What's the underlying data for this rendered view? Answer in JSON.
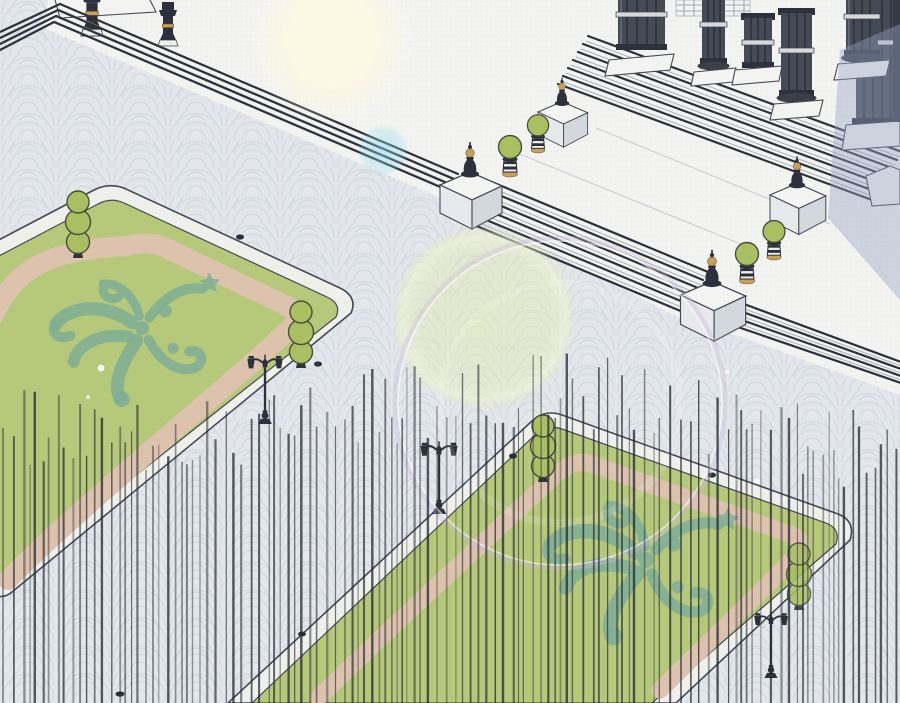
{
  "scene": {
    "title": "Palace courtyard plaza — isometric illustration",
    "description": "Overhead isometric webtoon-style background: a white stone colonnade terrace with two flights of grand stairs descends to a grey fan-patterned plaza. Two large lawn parterres with rounded white curbs contain pink walking paths and teal ornamental scroll emblems, flanked by stacked-ball topiaries and slim double-headed lamp posts. Urn finials on white pedestals and potted topiaries line the stairs. Soft lens flares float over the scene and a curtain of fine vertical screentone lines covers the lower half.",
    "style": "manhwa / webtoon background art",
    "time_of_day": "daylight"
  },
  "palette": {
    "plaza": "#e3e6ea",
    "pattern": "#c3cad4",
    "terrace": "#f3f4f2",
    "ink": "#2c313b",
    "outline": "#454a53",
    "curb": "#eff0ec",
    "lawn": "#b6c87a",
    "pink": "#ddc3ae",
    "orn": "#7fae96",
    "topiary": "#a9bf62",
    "gold": "#c9a05a",
    "shadow": "#96a3c4",
    "glow": "#fdf7e2",
    "flare_yellow": "#e3edaa",
    "flare_cyan": "#8cd7eb",
    "vline": "#272c36"
  },
  "objects": {
    "building": {
      "label": "colonnade portico",
      "columns": 6,
      "features": [
        "fluted dark columns",
        "light ring bands",
        "white plinths",
        "coffered wall panel",
        "cast shadow to lower right"
      ]
    },
    "stairs": {
      "label": "grand staircase",
      "flights": 2,
      "low_curb_bands": 2,
      "direction": "descends toward lower left"
    },
    "pedestal_finials": {
      "count": 4,
      "label": "white pedestals with dark urn finials and gold balls"
    },
    "potted_topiaries": {
      "count": 4,
      "label": "green ball topiary in striped white pot with gold foot"
    },
    "ball_topiaries": {
      "count": 4,
      "label": "stacked triple-ball topiary at lawn corners"
    },
    "lamp_posts": {
      "count": 3,
      "label": "slim double-headed courtyard lamp"
    },
    "parapet_lanterns": {
      "count": 2,
      "label": "dark lanterns with gold band on top-left parapet"
    },
    "lawns": [
      {
        "id": "left",
        "grass": "yellow-green",
        "path": "pink ring path",
        "emblem": "teal floral scroll emblem",
        "corner_topiaries": 2,
        "white_specks": 2
      },
      {
        "id": "right",
        "grass": "yellow-green",
        "path": "pink ring path",
        "emblem": "teal floral scroll emblem",
        "corner_topiaries": 2
      }
    ],
    "plaza": {
      "label": "grey plaza with fan-scallop cobblestone pattern"
    },
    "small_marks": {
      "count": 6,
      "label": "tiny dark fixtures / birds on curbs and pavement"
    }
  },
  "effects": {
    "lens_flares": [
      {
        "type": "soft glow",
        "cx": 332,
        "cy": 40,
        "r": 82,
        "color": "cream"
      },
      {
        "type": "disc",
        "cx": 383,
        "cy": 150,
        "r": 26,
        "color": "cyan"
      },
      {
        "type": "disc",
        "cx": 484,
        "cy": 318,
        "r": 93,
        "color": "yellow-green"
      },
      {
        "type": "ring",
        "cx": 560,
        "cy": 403,
        "r": 165,
        "color": "white-lavender"
      }
    ],
    "sparkles": [
      {
        "cx": 757,
        "cy": 481
      },
      {
        "cx": 783,
        "cy": 500
      },
      {
        "cx": 727,
        "cy": 372
      }
    ],
    "vertical_lines": {
      "seed": 7,
      "x_start": 3,
      "x_end": 898,
      "y_bottom": 703,
      "top_base": 360,
      "top_wave_amp": 30,
      "top_wave_period": 140,
      "top_slope": 0.04,
      "jitter": 80,
      "min_gap": 4.5,
      "gap_var": 6.5,
      "color": "#272c36"
    }
  }
}
